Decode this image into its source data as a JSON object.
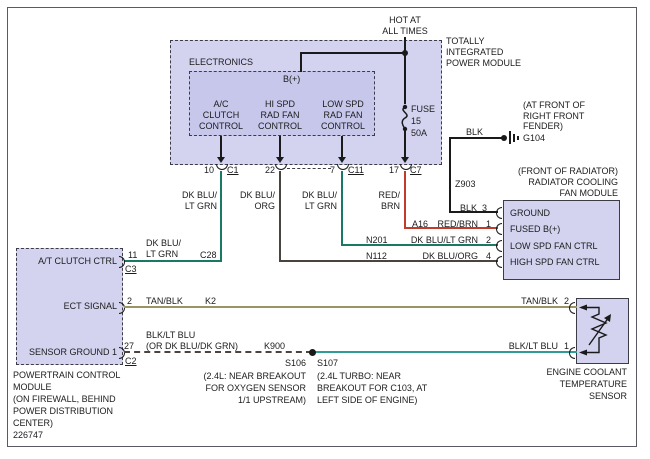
{
  "top": {
    "hot": "HOT AT\nALL TIMES",
    "fuse": "FUSE\n15\n50A"
  },
  "tipm": {
    "title": "TOTALLY\nINTEGRATED\nPOWER MODULE",
    "electronics": "ELECTRONICS",
    "b_plus": "B(+)",
    "controls": {
      "ac": "A/C\nCLUTCH\nCONTROL",
      "hi": "HI SPD\nRAD FAN\nCONTROL",
      "low": "LOW SPD\nRAD FAN\nCONTROL"
    },
    "pins": {
      "p10": "10",
      "c1": "C1",
      "p22": "22",
      "p7": "7",
      "c11": "C11",
      "p17": "17",
      "c7": "C7"
    }
  },
  "wire_labels": {
    "w10": "DK BLU/\nLT GRN",
    "w22": "DK BLU/\nORG",
    "w7": "DK BLU/\nLT GRN",
    "w17": "RED/\nBRN",
    "blk_top": "BLK",
    "z903": "Z903",
    "blk": "BLK",
    "p3": "3",
    "a16": "A16",
    "red_brn": "RED/BRN",
    "p1": "1",
    "n201": "N201",
    "dkblu_ltgrn": "DK BLU/LT GRN",
    "p2": "2",
    "n112": "N112",
    "dkblu_org": "DK BLU/ORG",
    "p4": "4",
    "at_wire": "DK BLU/\nLT GRN",
    "c28": "C28",
    "tan_blk": "TAN/BLK",
    "k2": "K2",
    "blk_ltblu": "BLK/LT BLU",
    "or_alt": "(OR DK BLU/DK GRN)",
    "k900": "K900",
    "tan_blk_r": "TAN/BLK",
    "s2": "2",
    "blk_ltblu_r": "BLK/LT BLU",
    "s1": "1"
  },
  "ground": {
    "note": "(AT FRONT OF\nRIGHT FRONT\nFENDER)",
    "id": "G104"
  },
  "fan_module": {
    "note": "(FRONT OF RADIATOR)\nRADIATOR COOLING\nFAN MODULE",
    "rows": [
      "GROUND",
      "FUSED B(+)",
      "LOW SPD FAN CTRL",
      "HIGH SPD FAN CTRL"
    ]
  },
  "pcm": {
    "rows": [
      "A/T CLUTCH CTRL",
      "ECT SIGNAL",
      "SENSOR GROUND 1"
    ],
    "p11": "11",
    "c3": "C3",
    "p2": "2",
    "p27": "27",
    "c2": "C2",
    "caption": "POWERTRAIN CONTROL\nMODULE\n(ON FIREWALL, BEHIND\nPOWER DISTRIBUTION\nCENTER)",
    "ref": "226747"
  },
  "splices": {
    "s106": "S106",
    "s106_note": "(2.4L: NEAR BREAKOUT\nFOR OXYGEN SENSOR\n1/1 UPSTREAM)",
    "s107": "S107",
    "s107_note": "(2.4L TURBO: NEAR\nBREAKOUT FOR C103, AT\nLEFT SIDE OF ENGINE)"
  },
  "sensor": {
    "caption": "ENGINE COOLANT\nTEMPERATURE\nSENSOR"
  },
  "colors": {
    "wire_green": "#187a64",
    "wire_red": "#c23b2b",
    "wire_dark": "#4a443e",
    "wire_tan": "#9b9565",
    "wire_teal": "#2f9d96",
    "wire_black": "#1a1a1a",
    "box_fill": "#d3d3f0",
    "inner_fill": "#c7c7ec"
  }
}
